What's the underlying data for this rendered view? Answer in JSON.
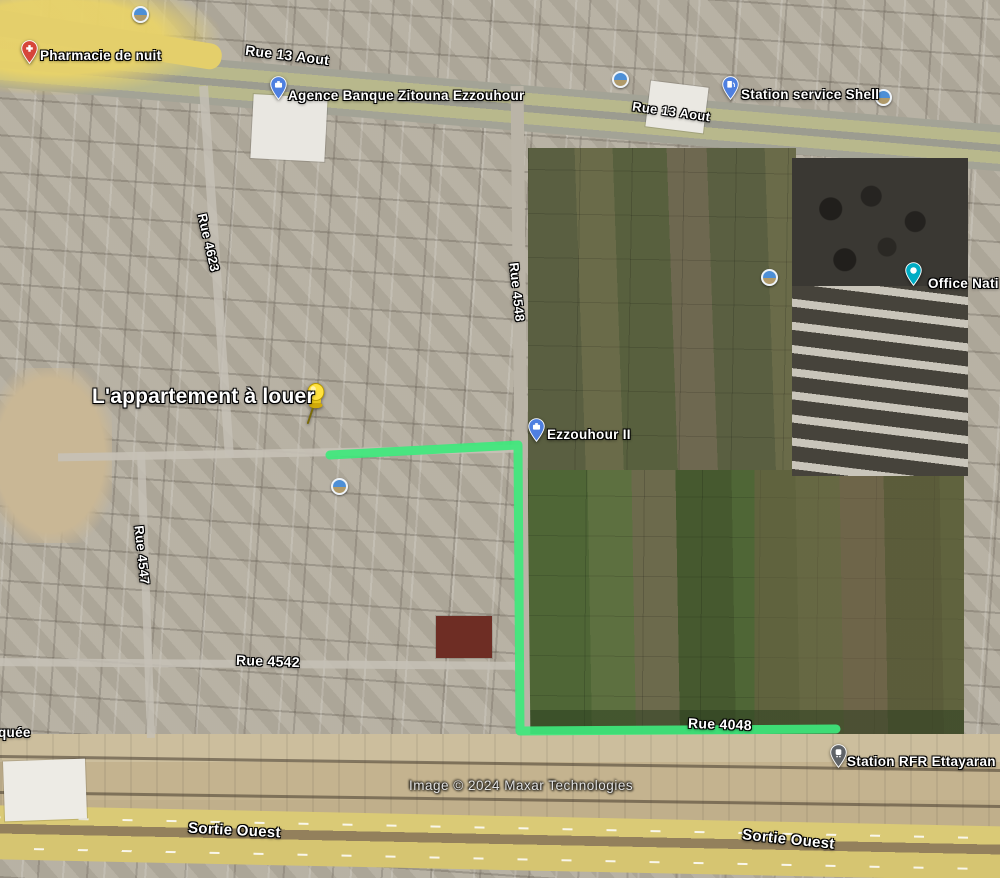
{
  "attribution": "Image © 2024 Maxar Technologies",
  "route": {
    "name": "drawn-route",
    "color": "#3ee87c"
  },
  "placemark": {
    "label": "L'appartement à louer",
    "icon": "yellow-pushpin-icon",
    "color": "#ffe23e"
  },
  "pois": [
    {
      "label": "Pharmacie de nuit",
      "type": "pharmacy",
      "pin_color": "#d6453a"
    },
    {
      "label": "Agence Banque Zitouna Ezzouhour",
      "type": "bank",
      "pin_color": "#4e7fe0"
    },
    {
      "label": "Station service Shell",
      "type": "gas-station",
      "pin_color": "#4e7fe0"
    },
    {
      "label": "Office Nati",
      "type": "office",
      "pin_color": "#00acc4"
    },
    {
      "label": "Ezzouhour II",
      "type": "locality",
      "pin_color": "#4e7fe0"
    },
    {
      "label": "Station RFR Ettayaran",
      "type": "train-station",
      "pin_color": "#5f6368"
    }
  ],
  "streets": [
    {
      "label": "Rue 13 Aout"
    },
    {
      "label": "Rue 13 Aout"
    },
    {
      "label": "Rue 4623"
    },
    {
      "label": "Rue 4548"
    },
    {
      "label": "Rue 4547"
    },
    {
      "label": "Rue 4542"
    },
    {
      "label": "Rue 4048"
    },
    {
      "label": "Sortie Ouest"
    },
    {
      "label": "Sortie Ouest"
    }
  ],
  "partial_labels": {
    "left_edge": "quée"
  },
  "icons": {
    "photo_spot": "photo-circle-icon"
  }
}
